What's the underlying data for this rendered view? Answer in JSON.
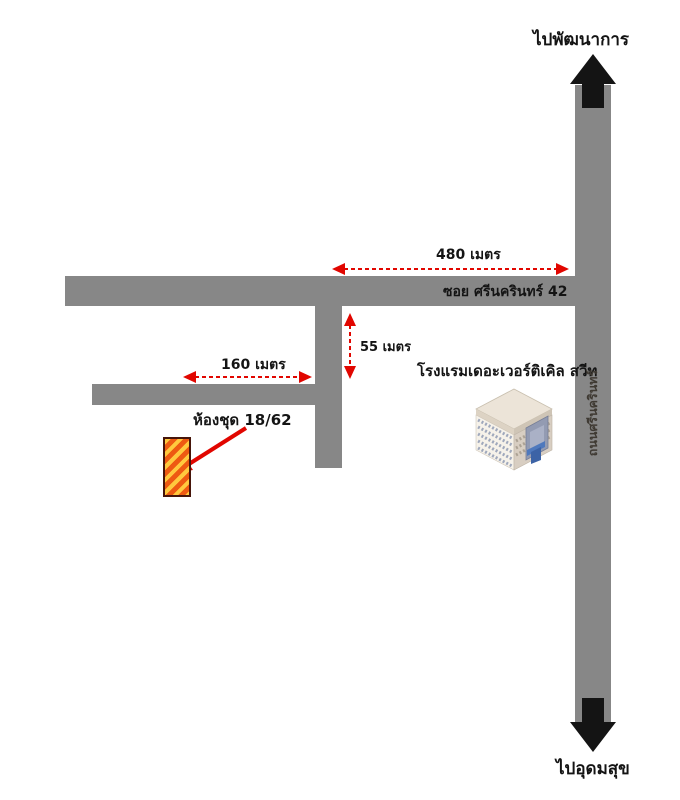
{
  "colors": {
    "road": "#878787",
    "ink": "#141414",
    "red": "#e10600",
    "road-text": "#3f3a33",
    "condo-yellow": "#ffc93e",
    "condo-orange": "#ee5a12",
    "condo-border": "#46150a"
  },
  "map": {
    "destinations": {
      "top": "ไปพัฒนาการ",
      "bottom": "ไปอุดมสุข"
    },
    "roads": {
      "main_vertical_name": "ถนนศรีนครินทร์",
      "soi_name": "ซอย ศรีนครินทร์ 42"
    },
    "distances": {
      "soi_length": "480 เมตร",
      "branch_left": "160 เมตร",
      "branch_down": "55 เมตร"
    },
    "places": {
      "condo_label": "ห้องชุด 18/62",
      "hotel_label": "โรงแรมเดอะเวอร์ติเคิล สวีท"
    }
  }
}
